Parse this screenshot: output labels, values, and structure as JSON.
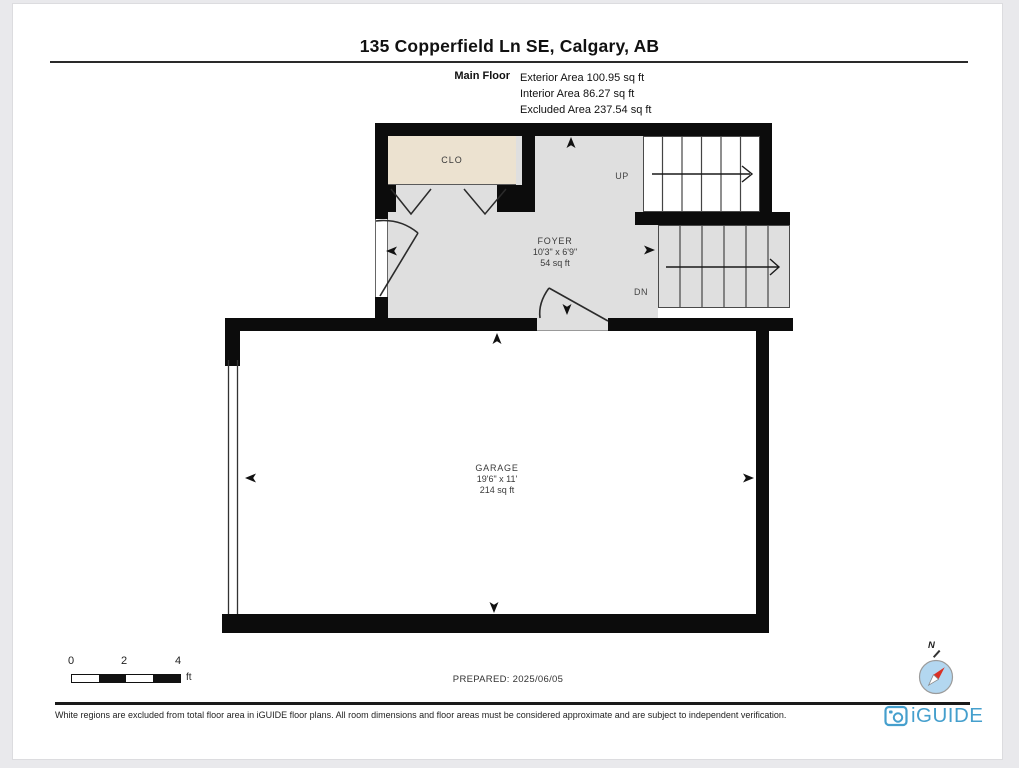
{
  "header": {
    "title": "135 Copperfield Ln SE, Calgary, AB",
    "floor_label": "Main Floor",
    "areas": {
      "exterior": "Exterior Area 100.95 sq ft",
      "interior": "Interior Area 86.27 sq ft",
      "excluded": "Excluded Area 237.54 sq ft"
    }
  },
  "rooms": {
    "closet": {
      "name": "CLO"
    },
    "foyer": {
      "name": "FOYER",
      "dims": "10'3\" x 6'9\"",
      "area": "54 sq ft"
    },
    "garage": {
      "name": "GARAGE",
      "dims": "19'6\" x 11'",
      "area": "214 sq ft"
    }
  },
  "stairs": {
    "up": "UP",
    "down": "DN"
  },
  "scale_bar": {
    "tick0": "0",
    "tick2": "2",
    "tick4": "4",
    "unit": "ft"
  },
  "prepared_label": "PREPARED: 2025/06/05",
  "compass": {
    "north": "N"
  },
  "footer": {
    "disclaimer": "White regions are excluded from total floor area in iGUIDE floor plans. All room dimensions and floor areas must be considered approximate and are subject to independent verification.",
    "brand": "iGUIDE"
  },
  "colors": {
    "wall": "#0c0c0c",
    "floor_gray": "#dfdfdf",
    "closet_beige": "#ece2d0",
    "brand_blue": "#459fcd",
    "compass_fill": "#b3d7f0",
    "needle_red": "#d93025"
  }
}
